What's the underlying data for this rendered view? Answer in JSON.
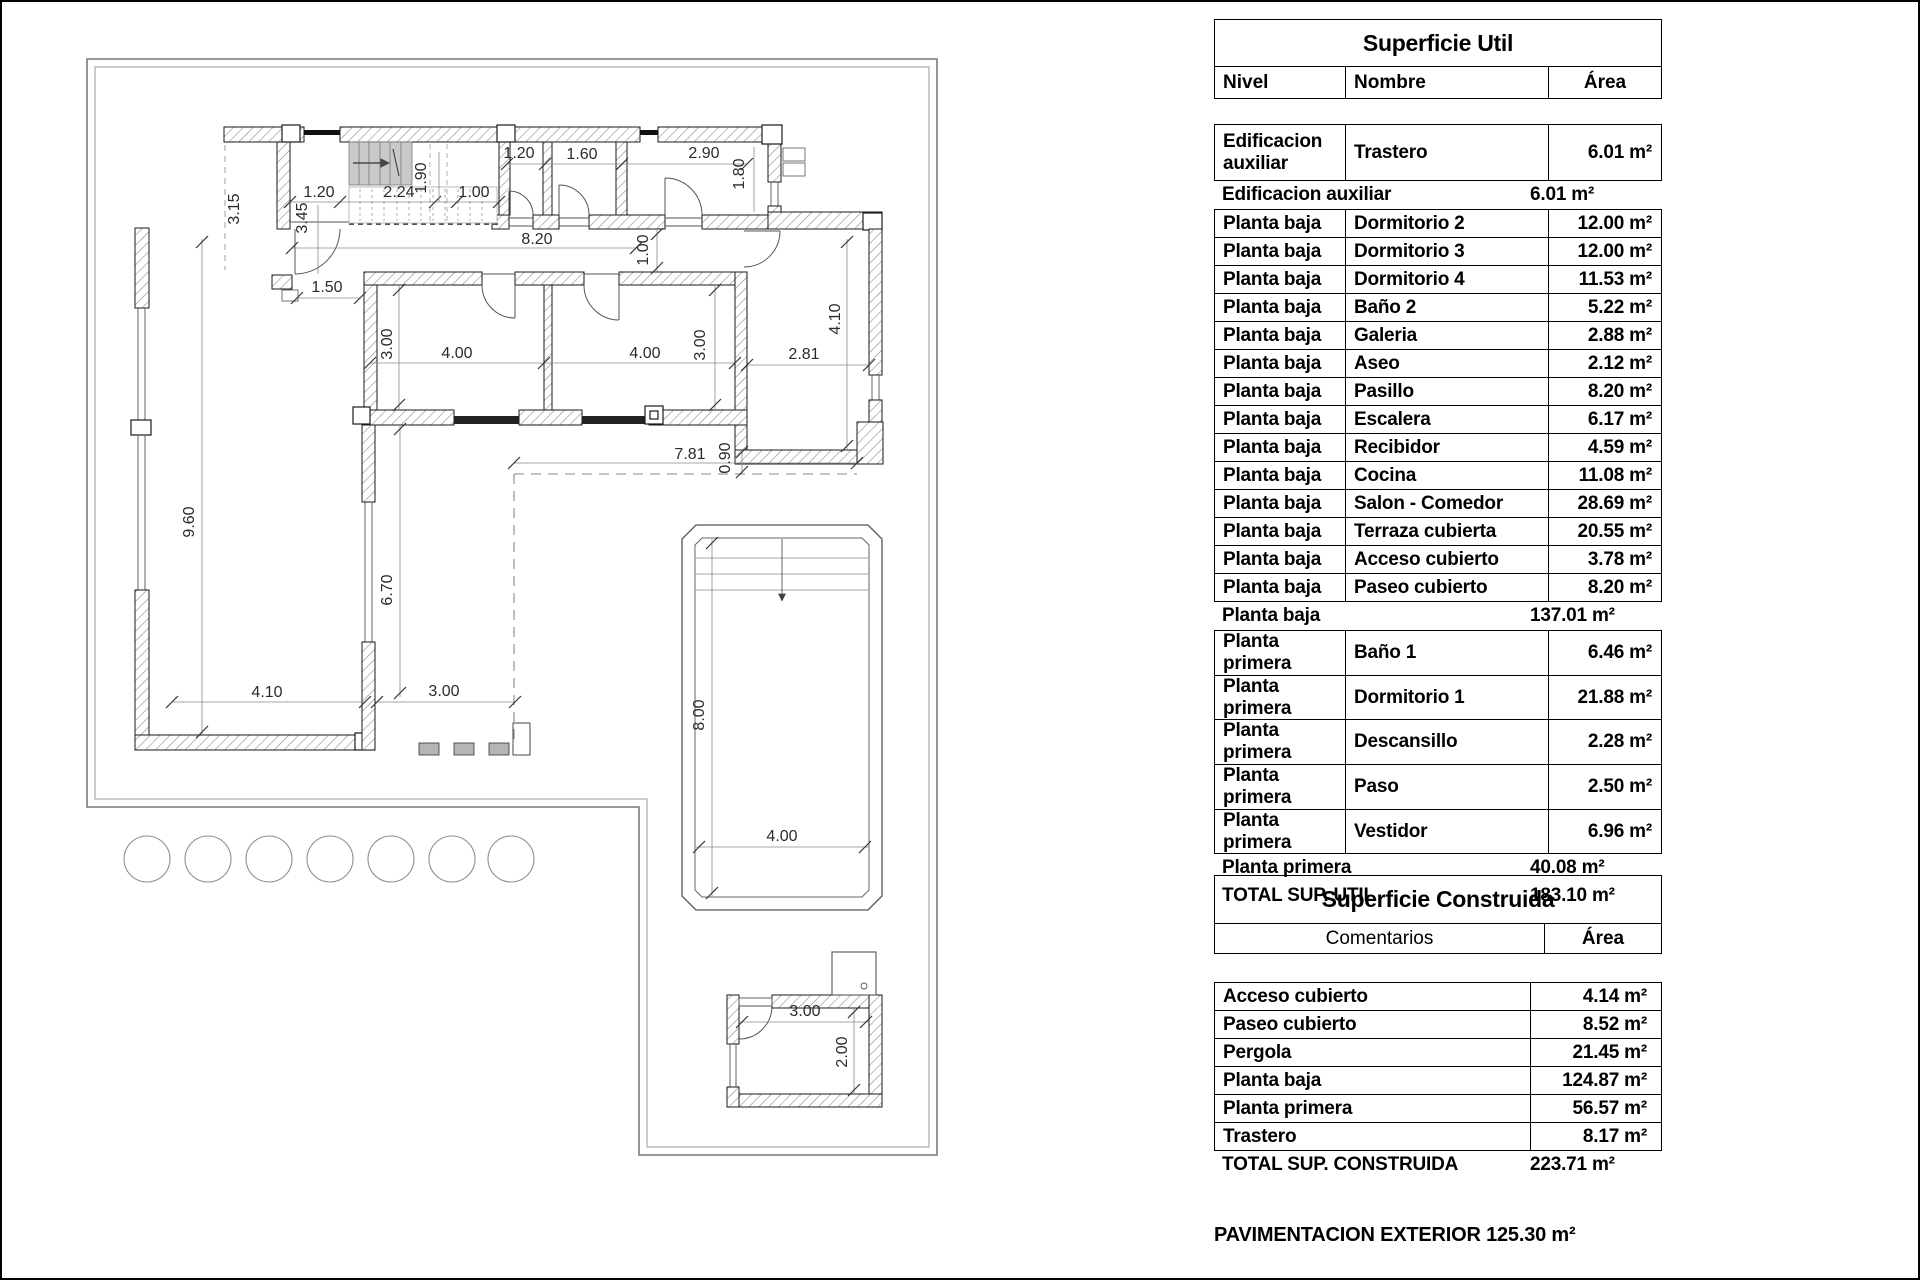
{
  "superficie_util": {
    "title": "Superficie Util",
    "columns": [
      "Nivel",
      "Nombre",
      "Área"
    ],
    "rows": [
      {
        "kind": "tall",
        "nivel": "Edificacion auxiliar",
        "nombre": "Trastero",
        "area": "6.01 m²"
      },
      {
        "kind": "sub",
        "label": "Edificacion auxiliar",
        "area": "6.01 m²"
      },
      {
        "kind": "item",
        "nivel": "Planta baja",
        "nombre": "Dormitorio 2",
        "area": "12.00 m²"
      },
      {
        "kind": "item",
        "nivel": "Planta baja",
        "nombre": "Dormitorio 3",
        "area": "12.00 m²"
      },
      {
        "kind": "item",
        "nivel": "Planta baja",
        "nombre": "Dormitorio 4",
        "area": "11.53 m²"
      },
      {
        "kind": "item",
        "nivel": "Planta baja",
        "nombre": "Baño 2",
        "area": "5.22 m²"
      },
      {
        "kind": "item",
        "nivel": "Planta baja",
        "nombre": "Galeria",
        "area": "2.88 m²"
      },
      {
        "kind": "item",
        "nivel": "Planta baja",
        "nombre": "Aseo",
        "area": "2.12 m²"
      },
      {
        "kind": "item",
        "nivel": "Planta baja",
        "nombre": "Pasillo",
        "area": "8.20 m²"
      },
      {
        "kind": "item",
        "nivel": "Planta baja",
        "nombre": "Escalera",
        "area": "6.17 m²"
      },
      {
        "kind": "item",
        "nivel": "Planta baja",
        "nombre": "Recibidor",
        "area": "4.59 m²"
      },
      {
        "kind": "item",
        "nivel": "Planta baja",
        "nombre": "Cocina",
        "area": "11.08 m²"
      },
      {
        "kind": "item",
        "nivel": "Planta baja",
        "nombre": "Salon - Comedor",
        "area": "28.69 m²"
      },
      {
        "kind": "item",
        "nivel": "Planta baja",
        "nombre": "Terraza cubierta",
        "area": "20.55 m²"
      },
      {
        "kind": "item",
        "nivel": "Planta baja",
        "nombre": "Acceso cubierto",
        "area": "3.78 m²"
      },
      {
        "kind": "item",
        "nivel": "Planta baja",
        "nombre": "Paseo cubierto",
        "area": "8.20 m²"
      },
      {
        "kind": "sub",
        "label": "Planta baja",
        "area": "137.01 m²"
      },
      {
        "kind": "item",
        "nivel": "Planta primera",
        "nombre": "Baño 1",
        "area": "6.46 m²"
      },
      {
        "kind": "item",
        "nivel": "Planta primera",
        "nombre": "Dormitorio 1",
        "area": "21.88 m²"
      },
      {
        "kind": "item",
        "nivel": "Planta primera",
        "nombre": "Descansillo",
        "area": "2.28 m²"
      },
      {
        "kind": "item",
        "nivel": "Planta primera",
        "nombre": "Paso",
        "area": "2.50 m²"
      },
      {
        "kind": "item",
        "nivel": "Planta primera",
        "nombre": "Vestidor",
        "area": "6.96 m²"
      },
      {
        "kind": "sub",
        "label": "Planta primera",
        "area": "40.08 m²"
      },
      {
        "kind": "total",
        "label": "TOTAL SUP. UTIL",
        "area": "183.10 m²"
      }
    ]
  },
  "superficie_construida": {
    "title": "Superficie Construida",
    "columns": [
      "Comentarios",
      "Área"
    ],
    "rows": [
      {
        "kind": "item",
        "label": "Acceso cubierto",
        "area": "4.14 m²"
      },
      {
        "kind": "item",
        "label": "Paseo cubierto",
        "area": "8.52 m²"
      },
      {
        "kind": "item",
        "label": "Pergola",
        "area": "21.45 m²"
      },
      {
        "kind": "item",
        "label": "Planta baja",
        "area": "124.87 m²"
      },
      {
        "kind": "item",
        "label": "Planta primera",
        "area": "56.57 m²"
      },
      {
        "kind": "item",
        "label": "Trastero",
        "area": "8.17 m²"
      },
      {
        "kind": "total",
        "label": "TOTAL SUP. CONSTRUIDA",
        "area": "223.71 m²"
      }
    ]
  },
  "footer": "PAVIMENTACION EXTERIOR 125.30 m²",
  "plan": {
    "dims": {
      "d01": "3.15",
      "d02": "1.20",
      "d03": "3.45",
      "d04": "2.24",
      "d05": "1.90",
      "d06": "1.00",
      "d07": "1.20",
      "d08": "1.60",
      "d09": "2.90",
      "d10": "1.80",
      "d11": "8.20",
      "d12": "1.00",
      "d13": "1.50",
      "d14": "3.00",
      "d15": "4.00",
      "d16": "4.00",
      "d17": "3.00",
      "d18": "2.81",
      "d19": "4.10",
      "d20": "9.60",
      "d21": "6.70",
      "d22": "4.10",
      "d23": "3.00",
      "d24": "7.81",
      "d25": "0.90",
      "d26": "8.00",
      "d27": "4.00",
      "d28": "3.00",
      "d29": "2.00"
    }
  }
}
